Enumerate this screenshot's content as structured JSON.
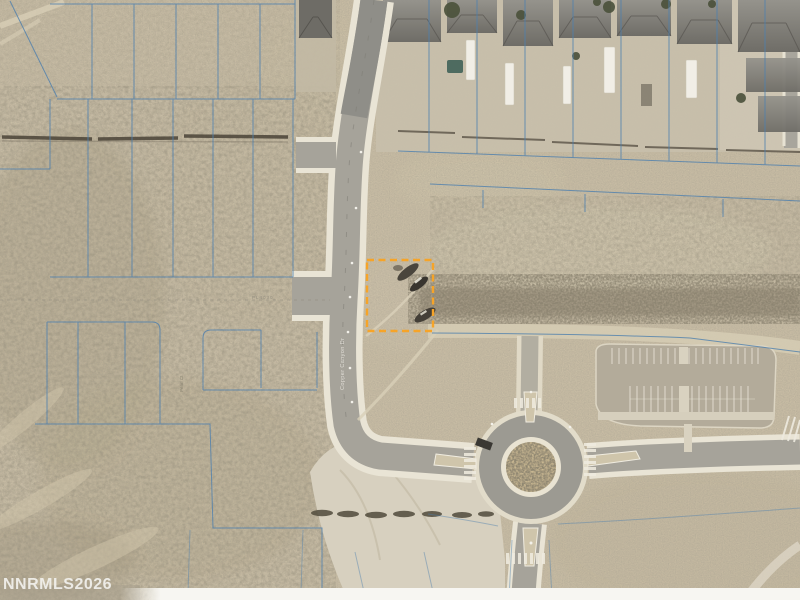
{
  "watermark": "NNRMLS2026",
  "map_labels": {
    "main_road_vertical": "Copper Canyon Dr",
    "plat_road_vertical": "Pearl Ct",
    "parcel_plat_note": "PL4030"
  },
  "highlight_parcel": {
    "color": "#F6A428",
    "style": "dashed-outline",
    "x": 367,
    "y": 260,
    "width": 66,
    "height": 71
  },
  "line_colors": {
    "parcel_boundary_blue": "#4D7FAE",
    "highlight_orange": "#F6A428"
  },
  "scene": {
    "type": "aerial-parcel-map",
    "features": [
      "residential-subdivision",
      "vacant-desert-parcels",
      "blue-parcel-grid",
      "main-road",
      "side-street-stubs",
      "roundabout",
      "empty-parking-lot",
      "highlighted-vacant-lot"
    ]
  }
}
